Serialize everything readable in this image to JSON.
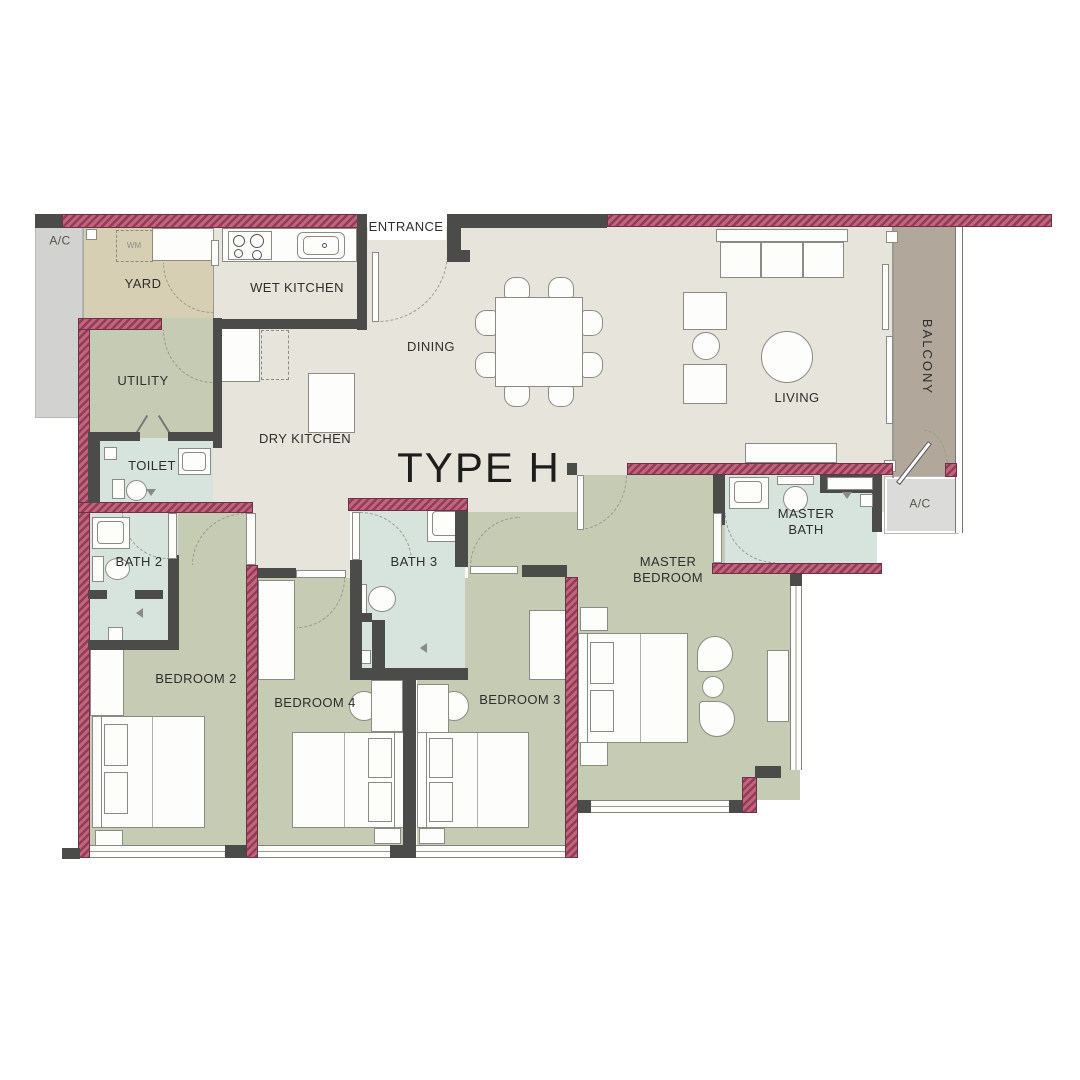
{
  "plan": {
    "title": "TYPE H",
    "labels": {
      "entrance": "ENTRANCE",
      "ac": "A/C",
      "yard": "YARD",
      "wet_kitchen": "WET KITCHEN",
      "dry_kitchen": "DRY KITCHEN",
      "dining": "DINING",
      "living": "LIVING",
      "balcony": "BALCONY",
      "utility": "UTILITY",
      "toilet": "TOILET",
      "bath2": "BATH 2",
      "bath3": "BATH 3",
      "master_bath_line1": "MASTER",
      "master_bath_line2": "BATH",
      "master_bedroom_line1": "MASTER",
      "master_bedroom_line2": "BEDROOM",
      "bedroom2": "BEDROOM 2",
      "bedroom3": "BEDROOM 3",
      "bedroom4": "BEDROOM 4",
      "washer": "WM"
    },
    "colors": {
      "floor_main": "#e7e4db",
      "floor_bedroom": "#c6cbb3",
      "floor_bath": "#d7e4de",
      "floor_yard": "#d7cfb4",
      "floor_balcony": "#b1a89b",
      "floor_ac": "#d2d2d0",
      "wall_interior": "#4b4b49",
      "wall_exterior": "#c4647c",
      "wall_exterior_stripe": "#8e3f57"
    }
  }
}
